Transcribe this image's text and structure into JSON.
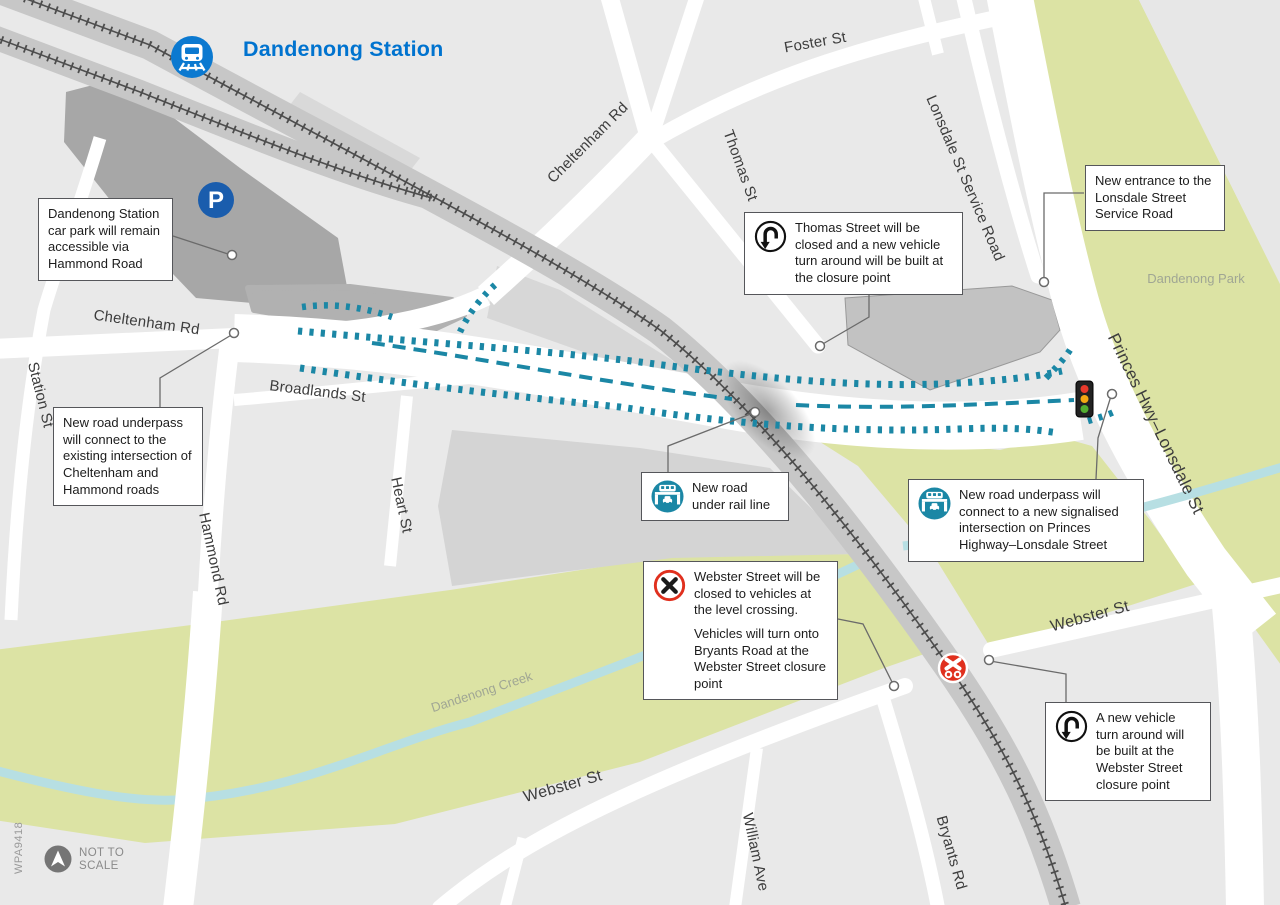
{
  "station": {
    "label": "Dandenong Station"
  },
  "icons": {
    "parking_glyph": "P"
  },
  "streets": {
    "foster": "Foster St",
    "cheltenham_upper": "Cheltenham Rd",
    "thomas": "Thomas St",
    "lonsdale_service": "Lonsdale St Service Road",
    "cheltenham_lower": "Cheltenham Rd",
    "station_st": "Station St",
    "broadlands": "Broadlands St",
    "hammond": "Hammond Rd",
    "heart": "Heart St",
    "princes": "Princes Hwy–Lonsdale St",
    "webster_west": "Webster St",
    "webster_east": "Webster St",
    "william": "William Ave",
    "bryants": "Bryants Rd"
  },
  "areas": {
    "park": "Dandenong Park",
    "creek": "Dandenong Creek"
  },
  "callouts": {
    "car_park": {
      "text": "Dandenong Station car park will remain accessible via Hammond Road"
    },
    "cheltenham_underpass": {
      "text": "New road underpass will connect to the existing intersection of Cheltenham and Hammond roads"
    },
    "thomas_closure": {
      "icon": "u-turn-icon",
      "text": "Thomas Street will be closed and a new vehicle turn around will be built at the closure point"
    },
    "lonsdale_entrance": {
      "text": "New entrance to the Lonsdale Street Service Road"
    },
    "rail_underpass": {
      "icon": "underpass-icon",
      "text": "New road under rail line"
    },
    "princes_underpass": {
      "icon": "underpass-icon",
      "text": "New road underpass will connect to a new signalised intersection on Princes Highway–Lonsdale Street"
    },
    "webster_closure": {
      "icon": "road-closed-icon",
      "text1": "Webster Street will be closed to vehicles at the level crossing.",
      "text2": "Vehicles will turn onto Bryants Road at the  Webster Street closure point"
    },
    "webster_turnaround": {
      "icon": "u-turn-icon",
      "text": "A new vehicle turn around will be built at the Webster Street closure point"
    }
  },
  "footer": {
    "scale_line1": "NOT TO",
    "scale_line2": "SCALE",
    "ref": "WPA9418"
  },
  "colors": {
    "station_blue": "#0073cf",
    "parking_blue": "#1a5dad",
    "proposal_teal": "#1b87a5",
    "closure_red": "#e0301e",
    "park_green": "#dce3a4",
    "creek_blue": "#b7dfe3",
    "rail_gray": "#c7c7c7"
  }
}
